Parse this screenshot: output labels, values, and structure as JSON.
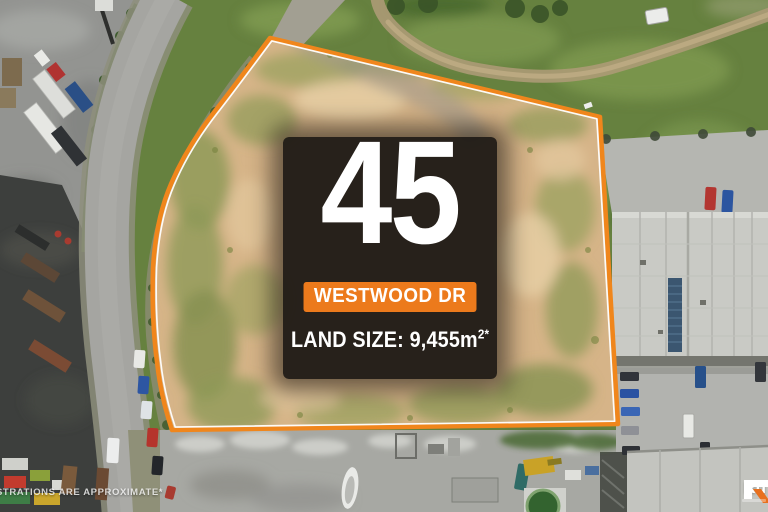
{
  "overlay": {
    "street_number": "45",
    "street_name": "WESTWOOD DR",
    "land_size_label": "LAND SIZE:",
    "land_size_value": "9,455m",
    "land_size_superscript": "2*"
  },
  "watermark": {
    "text": "STRATIONS ARE APPROXIMATE*"
  },
  "logo": {
    "text": "Ru"
  },
  "colors": {
    "boundary_orange": "#F0861C",
    "boundary_inner_white": "#FFFFFF",
    "badge_orange": "#EC7A1C",
    "logo_orange": "#E8701E",
    "panel_dark": "#181511",
    "parcel_tan": "#D6B488",
    "grass_green": "#66813F",
    "road_grey": "#A5A5A1",
    "roof_grey": "#C9CAC5"
  }
}
